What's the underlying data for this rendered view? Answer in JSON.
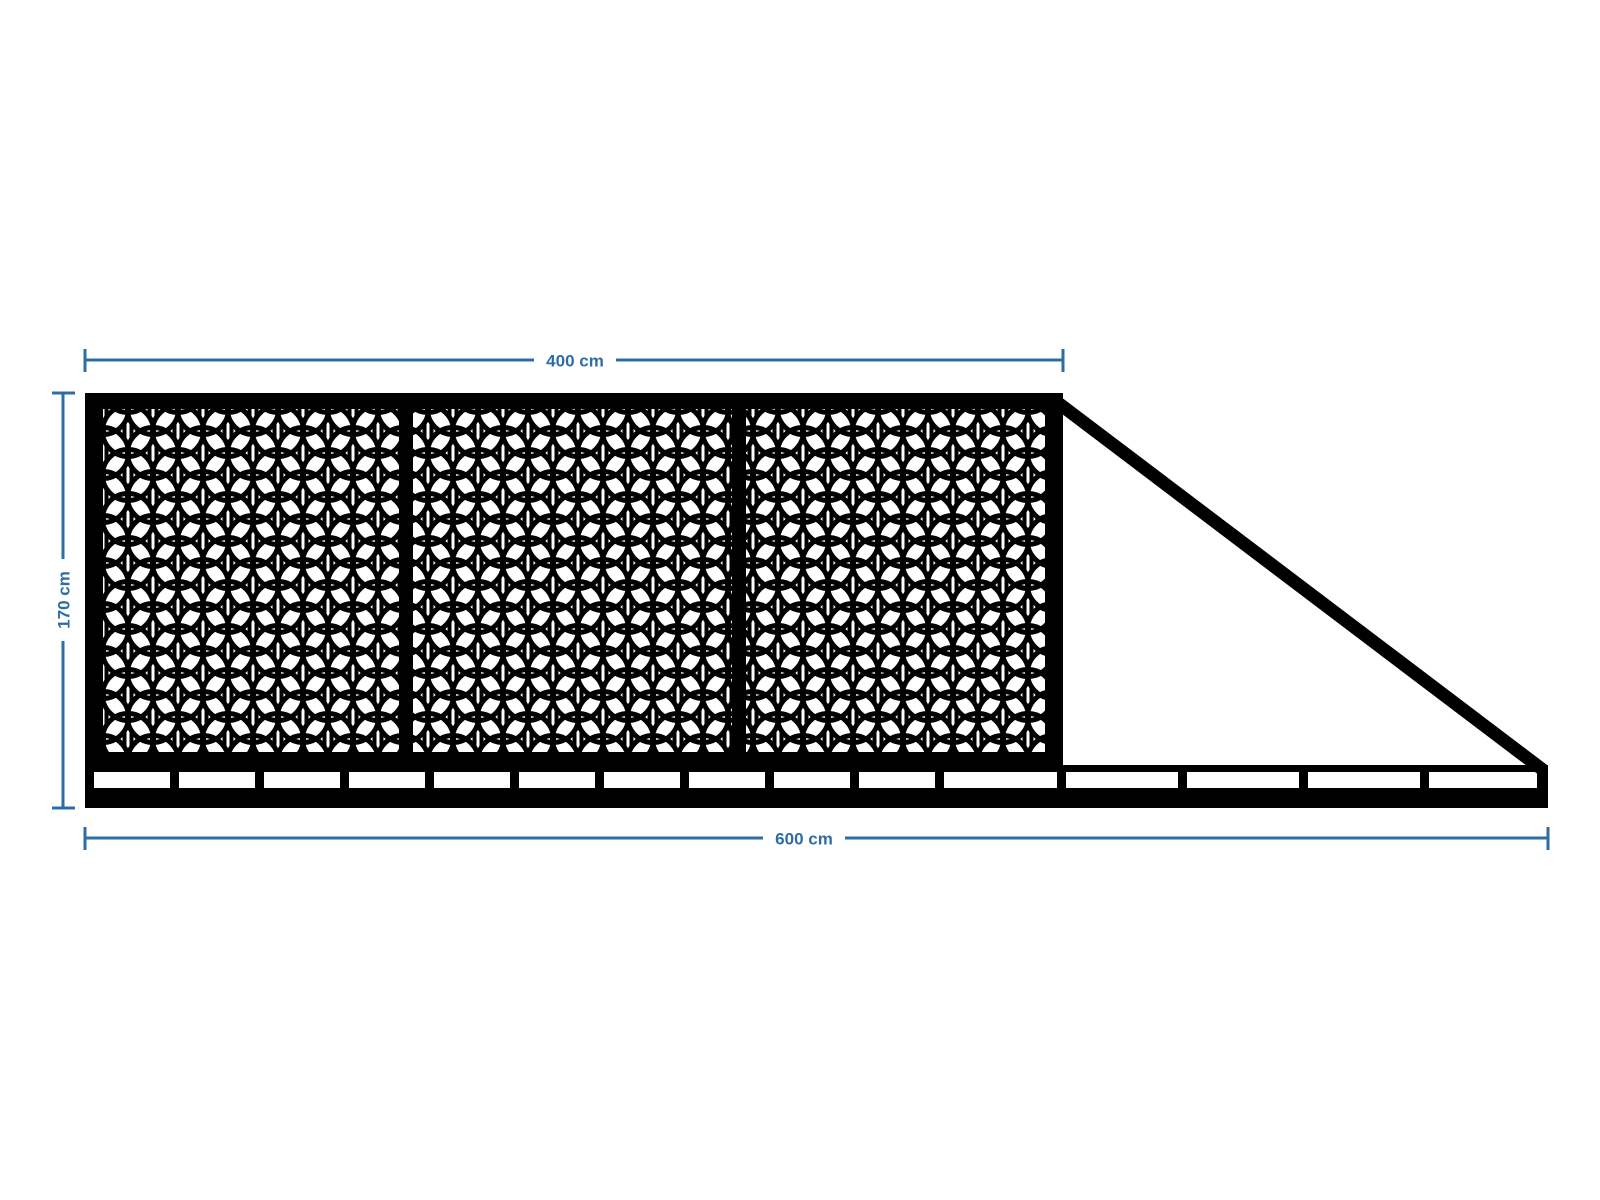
{
  "drawing": {
    "dimensions": {
      "gate_width_label": "400 cm",
      "total_width_label": "600 cm",
      "height_label": "170 cm"
    },
    "structure": {
      "type": "sliding-gate-elevation",
      "lattice_panels": 3,
      "lattice_pattern": "interlocking-circles-lattice",
      "tail": "triangular-counterbalance",
      "rail": "bottom-track-with-spacers"
    },
    "colors": {
      "steel": "#000000",
      "dimension_blue": "#2E6DA4",
      "background": "#FFFFFF"
    }
  }
}
